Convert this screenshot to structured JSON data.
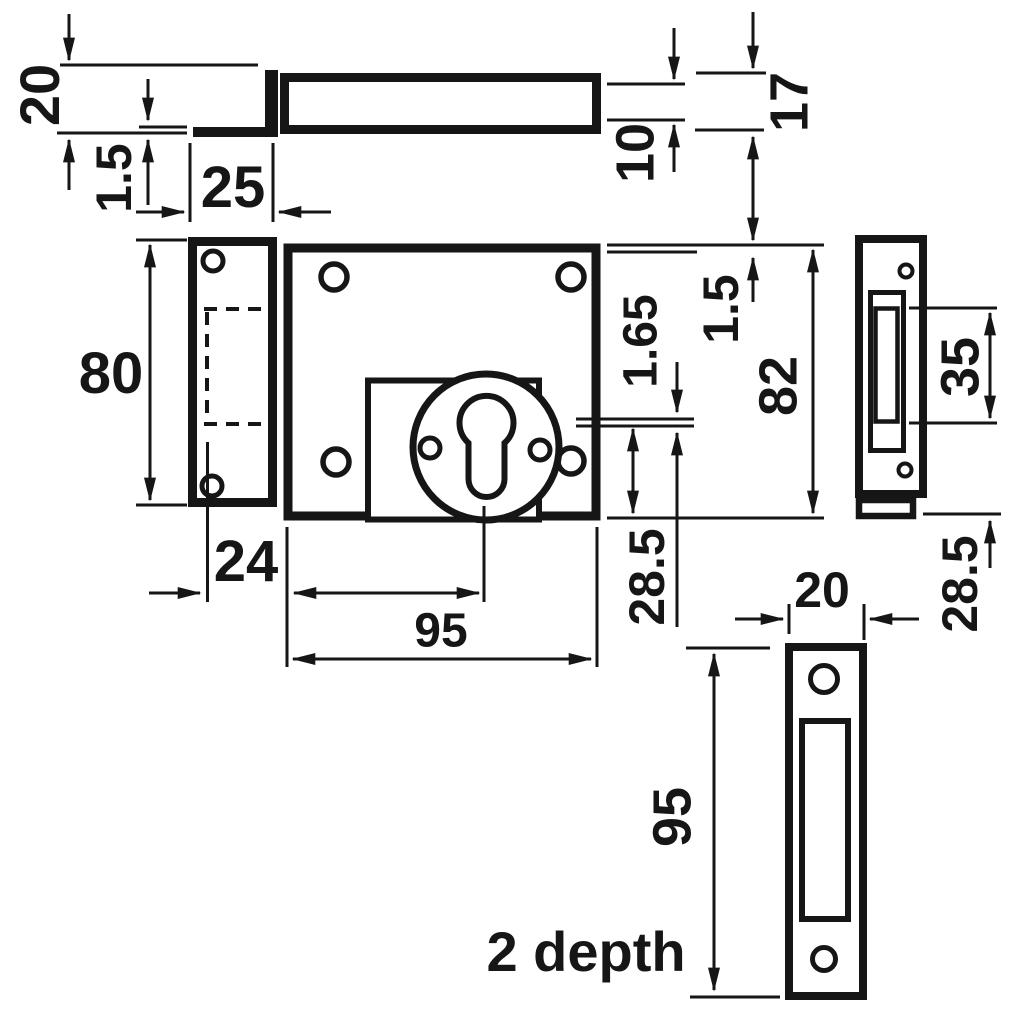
{
  "diagram": {
    "type": "technical-drawing",
    "subject": "lock case, faceplate, side profile and strike plate with dimensions",
    "background_color": "#ffffff",
    "line_color": "#161616",
    "views": [
      "top-view",
      "front-view",
      "side-view",
      "strike-plate-view"
    ]
  },
  "labels": {
    "faceplate_width": "20",
    "faceplate_thickness": "1.5",
    "faceplate_offset": "25",
    "case_depth_inner": "10",
    "overall_depth": "17",
    "faceplate_height": "80",
    "spindle_plate_thickness": "1.65",
    "top_clearance": "1.5",
    "case_height": "82",
    "bolt_line_offset": "28.5",
    "keyway_offset": "24",
    "case_width": "95",
    "slot_height": "35",
    "side_bolt_offset": "28.5",
    "strike_width": "20",
    "strike_height": "95",
    "strike_depth_note": "2 depth"
  }
}
